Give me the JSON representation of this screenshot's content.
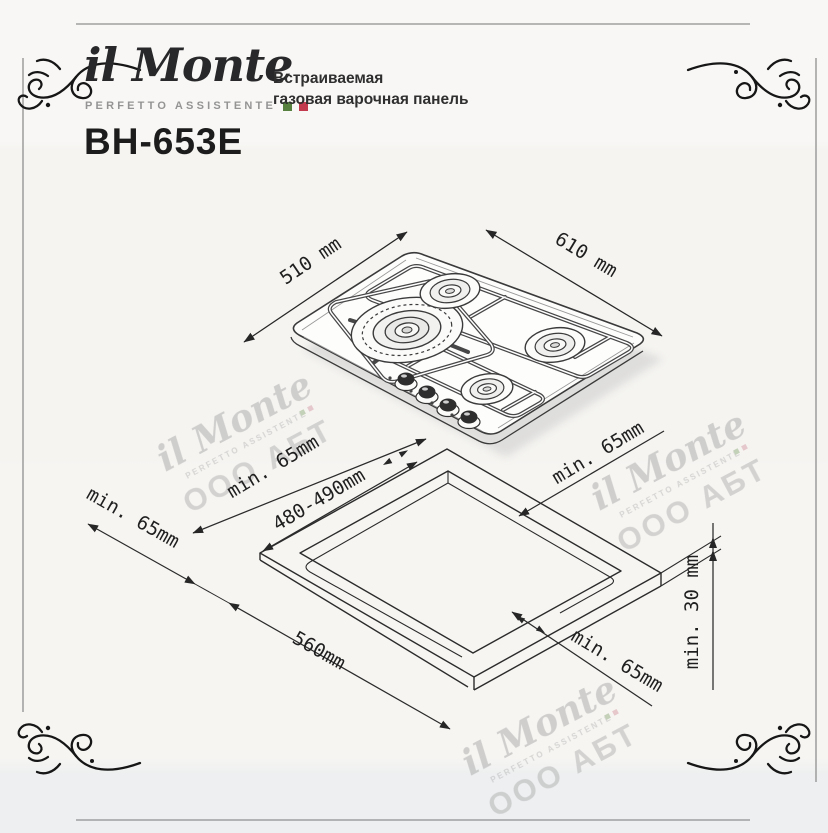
{
  "header": {
    "logo_name": "il Monte",
    "logo_tagline": "PERFETTO ASSISTENTE",
    "product_line1": "Встраиваемая",
    "product_line2": "газовая варочная панель",
    "model": "BH-653E"
  },
  "top_drawing": {
    "depth_label": "510 mm",
    "width_label": "610 mm"
  },
  "cutout_drawing": {
    "margin_top_left": "min.  65mm",
    "cutout_width": "480-490mm",
    "margin_top_right": "min.  65mm",
    "margin_left": "min.  65mm",
    "cutout_depth": "560mm",
    "margin_bottom_right": "min.  65mm",
    "worktop_thickness": "min.  30 mm"
  },
  "watermark": {
    "line1": "il Monte",
    "line2": "PERFETTO ASSISTENTE",
    "line3": "ООО АБТ"
  },
  "colors": {
    "accent_green": "#55803e",
    "accent_red": "#c13a4e",
    "ink": "#262626",
    "frame_gray": "#8f8f8f",
    "watermark_gray": "#a3a3a3"
  }
}
